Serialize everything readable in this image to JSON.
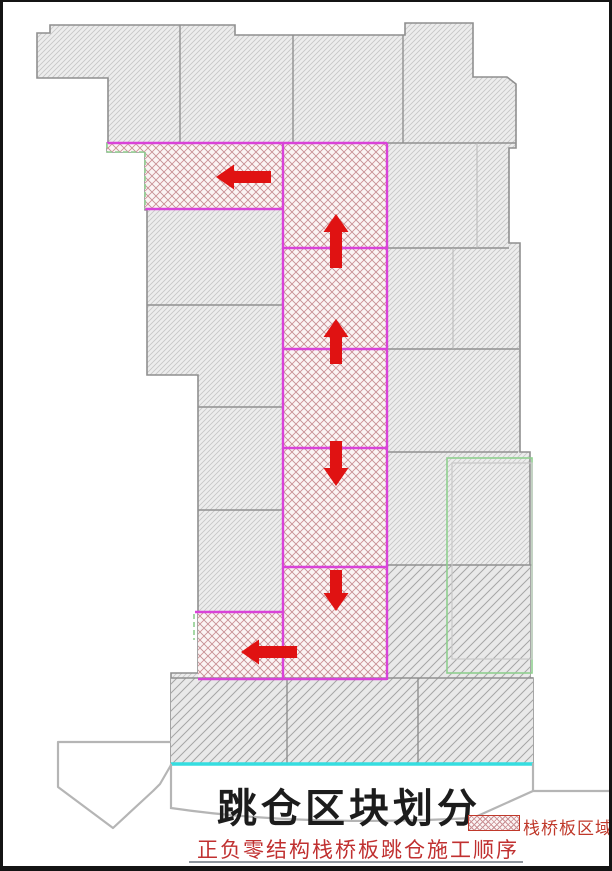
{
  "title": "跳仓区块划分",
  "caption": "正负零结构栈桥板跳仓施工顺序",
  "legend": {
    "label": "栈桥板区域"
  },
  "colors": {
    "arrow_red": "#e01212",
    "pour_strip_magenta": "#d943d9",
    "trestle_hatch_red": "#c9898f",
    "outline_gray": "#8f8f8f",
    "waterline_cyan": "#35dde0",
    "zone_green": "#8fcf8f",
    "title_black": "#1c1c1c",
    "text_red": "#c03030"
  },
  "plan": {
    "hatched_zone_label": "栈桥板区域",
    "arrows": [
      {
        "direction": "left",
        "tip": [
          216,
          177
        ],
        "length": 55
      },
      {
        "direction": "up",
        "tip": [
          336,
          214
        ],
        "length": 54
      },
      {
        "direction": "up",
        "tip": [
          336,
          319
        ],
        "length": 45
      },
      {
        "direction": "down",
        "tip": [
          336,
          486
        ],
        "length": 45
      },
      {
        "direction": "down",
        "tip": [
          336,
          611
        ],
        "length": 41
      },
      {
        "direction": "left",
        "tip": [
          241,
          652
        ],
        "length": 56
      }
    ]
  }
}
